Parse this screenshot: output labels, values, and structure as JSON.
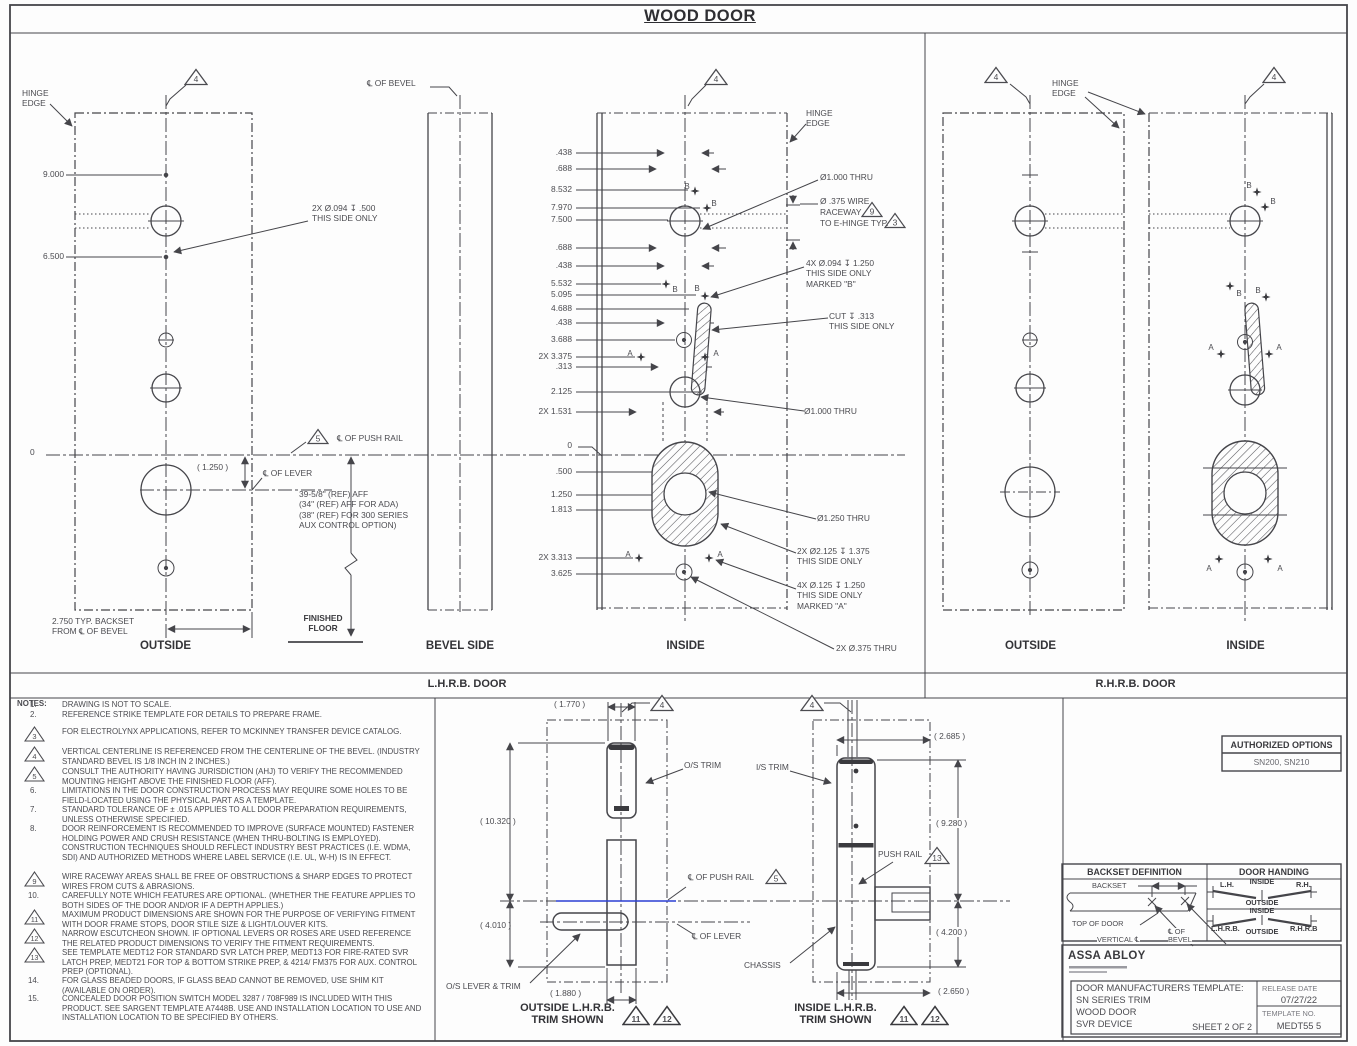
{
  "colors": {
    "line": "#45454a",
    "text": "#4b4b50",
    "accent_blue": "#2b3fd4"
  },
  "title": "WOOD DOOR",
  "sections": {
    "lhrb": "L.H.R.B. DOOR",
    "rhrb": "R.H.R.B. DOOR"
  },
  "flags": {
    "n3": "3",
    "n4": "4",
    "n5": "5",
    "n9": "9",
    "n11": "11",
    "n12": "12",
    "n13": "13"
  },
  "markers": {
    "a": "A",
    "b": "B"
  },
  "lhrb": {
    "outside": {
      "hinge_edge": "HINGE\nEDGE",
      "dim_9": "9.000",
      "dim_65": "6.500",
      "zero": "0",
      "callout_094": "2X Ø.094 ↧ .500\nTHIS SIDE ONLY",
      "dim_125": "( 1.250 )",
      "cl_lever": "℄ OF LEVER",
      "cl_push_rail": "℄ OF PUSH RAIL",
      "backset": "2.750 TYP. BACKSET\nFROM ℄ OF BEVEL",
      "caption": "OUTSIDE"
    },
    "bevel": {
      "cl": "℄ OF BEVEL",
      "caption": "BEVEL SIDE"
    },
    "aff_note": "39-5/8\" (REF) AFF\n(34\" (REF) AFF FOR ADA)\n(38\" (REF) FOR 300 SERIES\nAUX CONTROL OPTION)",
    "finished_floor": "FINISHED\nFLOOR",
    "inside": {
      "hinge_edge": "HINGE\nEDGE",
      "caption": "INSIDE",
      "dims": [
        ".438",
        ".688",
        "8.532",
        "7.970",
        "7.500",
        ".688",
        ".438",
        "5.532",
        "5.095",
        "4.688",
        ".438",
        "3.688",
        "2X 3.375",
        ".313",
        "2.125",
        "2X 1.531",
        "0",
        ".500",
        "1.250",
        "1.813",
        "2X 3.313",
        "3.625"
      ],
      "callouts": {
        "c1": "Ø1.000 THRU",
        "c2a": "Ø .375 WIRE",
        "c2b": "RACEWAY",
        "c2c": "TO E-HINGE TYP.",
        "c3": "4X Ø.094 ↧ 1.250\nTHIS SIDE ONLY\nMARKED \"B\"",
        "c4": "CUT ↧ .313\nTHIS SIDE ONLY",
        "c5": "Ø1.000 THRU",
        "c6": "Ø1.250 THRU",
        "c7": "2X Ø2.125 ↧ 1.375\nTHIS SIDE ONLY",
        "c8": "4X Ø.125 ↧ 1.250\nTHIS SIDE ONLY\nMARKED \"A\"",
        "c9": "2X Ø.375 THRU"
      }
    }
  },
  "rhrb": {
    "hinge_edge": "HINGE\nEDGE",
    "outside_caption": "OUTSIDE",
    "inside_caption": "INSIDE"
  },
  "notes": {
    "header": "NOTES:",
    "items": [
      {
        "num": "1.",
        "text": "DRAWING IS NOT TO SCALE."
      },
      {
        "num": "2.",
        "text": "REFERENCE STRIKE TEMPLATE FOR DETAILS TO PREPARE FRAME."
      },
      {
        "num": "3",
        "text": "FOR ELECTROLYNX APPLICATIONS, REFER TO MCKINNEY TRANSFER DEVICE CATALOG."
      },
      {
        "num": "4",
        "text": "VERTICAL CENTERLINE IS REFERENCED FROM THE CENTERLINE OF THE BEVEL. (INDUSTRY STANDARD BEVEL IS 1/8 INCH IN 2 INCHES.)"
      },
      {
        "num": "5",
        "text": "CONSULT THE AUTHORITY HAVING JURISDICTION (AHJ) TO VERIFY THE RECOMMENDED MOUNTING HEIGHT ABOVE THE FINISHED FLOOR (AFF)."
      },
      {
        "num": "6.",
        "text": "LIMITATIONS IN THE DOOR CONSTRUCTION PROCESS MAY REQUIRE SOME HOLES TO BE FIELD-LOCATED USING THE PHYSICAL PART AS A TEMPLATE."
      },
      {
        "num": "7.",
        "text": "STANDARD TOLERANCE OF ± .015 APPLIES TO ALL DOOR PREPARATION REQUIREMENTS, UNLESS OTHERWISE SPECIFIED."
      },
      {
        "num": "8.",
        "text": "DOOR REINFORCEMENT IS RECOMMENDED TO IMPROVE (SURFACE MOUNTED) FASTENER HOLDING POWER AND CRUSH RESISTANCE (WHEN THRU-BOLTING IS EMPLOYED). CONSTRUCTION TECHNIQUES SHOULD REFLECT INDUSTRY BEST PRACTICES (I.E. WDMA, SDI) AND AUTHORIZED METHODS WHERE LABEL SERVICE (I.E. UL, W-H) IS IN EFFECT."
      },
      {
        "num": "9",
        "text": "WIRE RACEWAY AREAS SHALL BE FREE OF OBSTRUCTIONS & SHARP EDGES TO PROTECT WIRES FROM CUTS & ABRASIONS."
      },
      {
        "num": "10.",
        "text": "CAREFULLY NOTE WHICH FEATURES ARE OPTIONAL. (WHETHER THE FEATURE APPLIES TO BOTH SIDES OF THE DOOR AND/OR IF A DEPTH APPLIES.)"
      },
      {
        "num": "11",
        "text": "MAXIMUM PRODUCT DIMENSIONS ARE SHOWN FOR THE PURPOSE OF VERIFYING FITMENT WITH DOOR FRAME STOPS, DOOR STILE SIZE & LIGHT/LOUVER KITS."
      },
      {
        "num": "12",
        "text": "NARROW ESCUTCHEON SHOWN. IF OPTIONAL LEVERS OR ROSES ARE USED REFERENCE THE RELATED PRODUCT DIMENSIONS TO VERIFY THE FITMENT REQUIREMENTS."
      },
      {
        "num": "13",
        "text": "SEE TEMPLATE MEDT12 FOR STANDARD SVR LATCH PREP, MEDT13 FOR FIRE-RATED SVR LATCH PREP, MEDT21 FOR TOP & BOTTOM STRIKE PREP, & 4214/ FM375 FOR AUX. CONTROL PREP (OPTIONAL)."
      },
      {
        "num": "14.",
        "text": "FOR  GLASS BEADED DOORS, IF GLASS BEAD CANNOT BE REMOVED, USE SHIM KIT (AVAILABLE ON ORDER)."
      },
      {
        "num": "15.",
        "text": "CONCEALED DOOR POSITION SWITCH MODEL 3287 / 708F989 IS INCLUDED WITH THIS PRODUCT. SEE SARGENT TEMPLATE A7448B. USE AND INSTALLATION LOCATION TO USE AND INSTALLATION LOCATION TO BE SPECIFIED BY OTHERS."
      }
    ]
  },
  "trim_outside": {
    "w_top": "( 1.770 )",
    "h_main": "( 10.320 )",
    "h_low": "( 4.010 )",
    "w_bot": "( 1.880 )",
    "os_trim": "O/S TRIM",
    "cl_push_rail": "℄ OF PUSH RAIL",
    "cl_lever": "℄ OF LEVER",
    "os_lever": "O/S LEVER & TRIM",
    "caption": "OUTSIDE L.H.R.B.\nTRIM SHOWN"
  },
  "trim_inside": {
    "w_top": "( 2.685 )",
    "h_main": "( 9.280 )",
    "h_low": "( 4.200 )",
    "w_bot": "( 2.650 )",
    "is_trim": "I/S TRIM",
    "push_rail": "PUSH RAIL",
    "chassis": "CHASSIS",
    "caption": "INSIDE L.H.R.B.\nTRIM SHOWN"
  },
  "authorized_options": {
    "header": "AUTHORIZED OPTIONS",
    "value": "SN200, SN210"
  },
  "backset_def": {
    "header": "BACKSET DEFINITION",
    "backset": "BACKSET",
    "top_of_door": "TOP OF DOOR",
    "vertical_cl": "VERTICAL ℄",
    "cl_of_bevel": "℄ OF\nBEVEL"
  },
  "door_handing": {
    "header": "DOOR HANDING",
    "lh": "L.H.",
    "rh": "R.H.",
    "inside1": "INSIDE",
    "outside1": "OUTSIDE",
    "inside2": "INSIDE",
    "outside2": "OUTSIDE",
    "lhrb": "L.H.R.B.",
    "rhrb": "R.H.R.B"
  },
  "title_block": {
    "brand": "ASSA ABLOY",
    "template_title": "DOOR MANUFACTURERS TEMPLATE:",
    "product1": "SN SERIES TRIM",
    "product2": "WOOD DOOR",
    "product3": "SVR DEVICE",
    "sheet": "SHEET 2 OF 2",
    "release_label": "RELEASE  DATE",
    "release_date": "07/27/22",
    "template_label": "TEMPLATE  NO.",
    "template_no": "MEDT55  5"
  }
}
